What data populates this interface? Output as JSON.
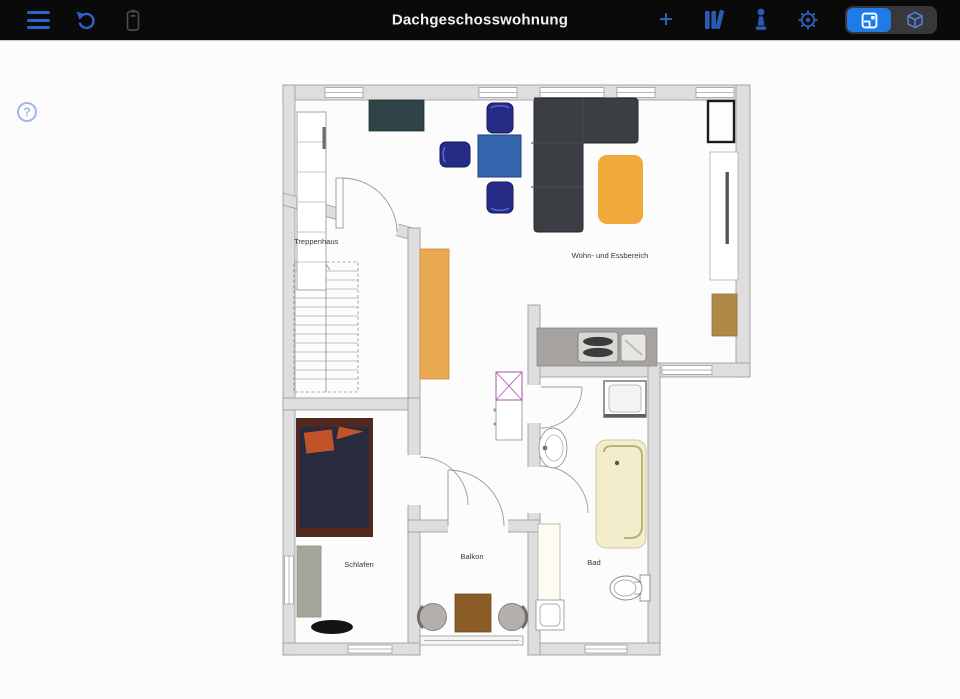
{
  "toolbar": {
    "title": "Dachgeschosswohnung",
    "plus_label": "+"
  },
  "help": {
    "label": "?"
  },
  "rooms": {
    "treppenhaus": "Treppenhaus",
    "wohnen": "Wohn- und Essbereich",
    "schlafen": "Schlafen",
    "balkon": "Balkon",
    "bad": "Bad"
  },
  "colors": {
    "toolbar_bg": "#0a0a0b",
    "accent_blue": "#1f7ce6",
    "icon_blue": "#2e62c9",
    "icon_dim_blue": "#2a5bb0",
    "wall_fill": "#dedede",
    "wall_stroke": "#9f9f9f",
    "sofa": "#3b3e42",
    "table_blue": "#3265ae",
    "chair_navy": "#262b86",
    "rug": "#f2a93b",
    "sideboard": "#2f4447",
    "wardrobe_tan": "#eaa950",
    "bed_frame": "#53281e",
    "bed_duvet": "#272b3d",
    "pillow": "#c05327",
    "tub": "#f2eecb",
    "wood_box": "#b08948",
    "balcony_table": "#8a5c28",
    "bedroom_wardrobe": "#a3a79a"
  }
}
